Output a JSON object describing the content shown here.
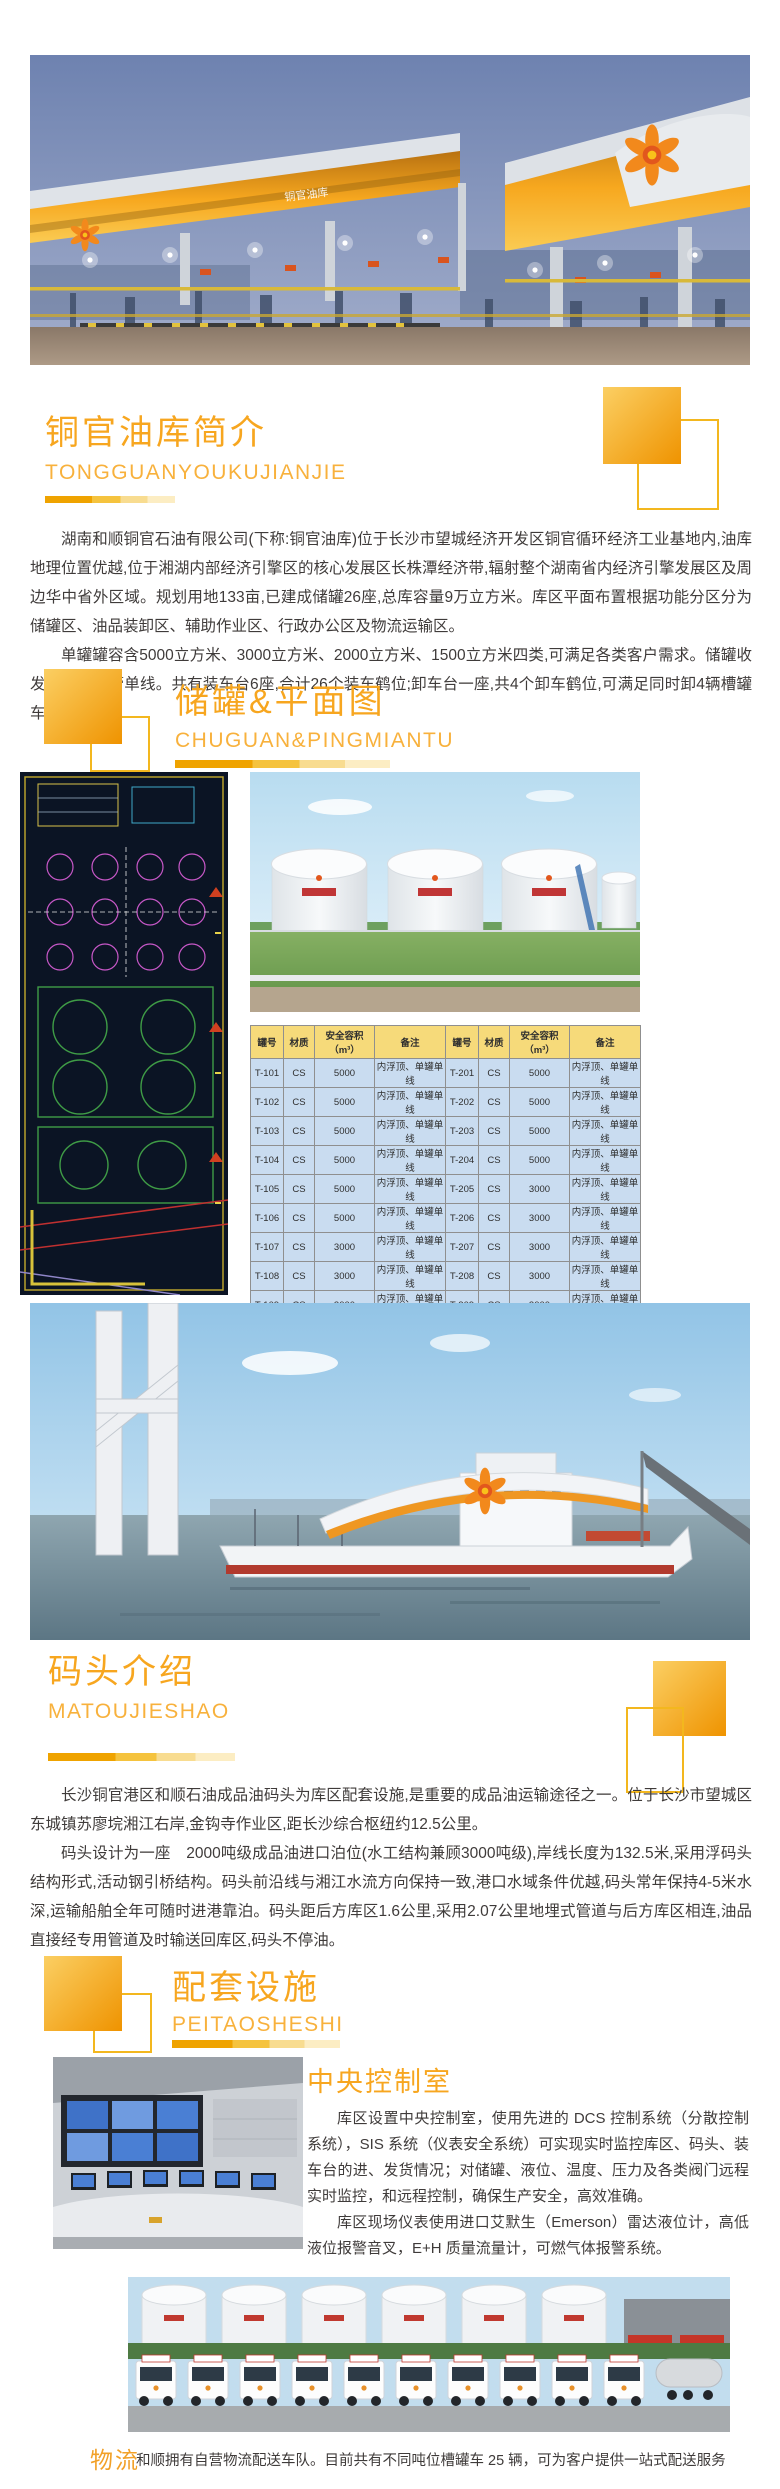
{
  "colors": {
    "accent_orange": "#F7A61F",
    "pinyin_orange": "#F8B13C",
    "table_header_bg": "#F6DA7A",
    "table_row_bg": "#C9DCF0",
    "body_text": "#3F3B3A"
  },
  "hero": {
    "canopy_sign": "铜官油库"
  },
  "section_intro": {
    "title": "铜官油库简介",
    "pinyin": "TONGGUANYOUKUJIANJIE",
    "paragraphs": {
      "p1": "湖南和顺铜官石油有限公司(下称:铜官油库)位于长沙市望城经济开发区铜官循环经济工业基地内,油库地理位置优越,位于湘湖内部经济引擎区的核心发展区长株潭经济带,辐射整个湖南省内经济引擎发展区及周边华中省外区域。规划用地133亩,已建成储罐26座,总库容量9万立方米。库区平面布置根据功能分区分为储罐区、油品装卸区、辅助作业区、行政办公区及物流运输区。",
      "p2": "单罐罐容含5000立方米、3000立方米、2000立方米、1500立方米四类,可满足各类客户需求。储罐收发油均为单管单线。共有装车台6座,合计26个装车鹤位;卸车台一座,共4个卸车鹤位,可满足同时卸4辆槽罐车。"
    }
  },
  "section_tanks": {
    "title": "储罐&平面图",
    "pinyin": "CHUGUAN&PINGMIANTU"
  },
  "tank_table": {
    "headers": [
      "罐号",
      "材质",
      "安全容积（m³）",
      "备注",
      "罐号",
      "材质",
      "安全容积（m³）",
      "备注"
    ],
    "rows": [
      [
        "T-101",
        "CS",
        "5000",
        "内浮顶、单罐单线",
        "T-201",
        "CS",
        "5000",
        "内浮顶、单罐单线"
      ],
      [
        "T-102",
        "CS",
        "5000",
        "内浮顶、单罐单线",
        "T-202",
        "CS",
        "5000",
        "内浮顶、单罐单线"
      ],
      [
        "T-103",
        "CS",
        "5000",
        "内浮顶、单罐单线",
        "T-203",
        "CS",
        "5000",
        "内浮顶、单罐单线"
      ],
      [
        "T-104",
        "CS",
        "5000",
        "内浮顶、单罐单线",
        "T-204",
        "CS",
        "5000",
        "内浮顶、单罐单线"
      ],
      [
        "T-105",
        "CS",
        "5000",
        "内浮顶、单罐单线",
        "T-205",
        "CS",
        "3000",
        "内浮顶、单罐单线"
      ],
      [
        "T-106",
        "CS",
        "5000",
        "内浮顶、单罐单线",
        "T-206",
        "CS",
        "3000",
        "内浮顶、单罐单线"
      ],
      [
        "T-107",
        "CS",
        "3000",
        "内浮顶、单罐单线",
        "T-207",
        "CS",
        "3000",
        "内浮顶、单罐单线"
      ],
      [
        "T-108",
        "CS",
        "3000",
        "内浮顶、单罐单线",
        "T-208",
        "CS",
        "3000",
        "内浮顶、单罐单线"
      ],
      [
        "T-109",
        "CS",
        "3000",
        "内浮顶、单罐单线",
        "T-209",
        "CS",
        "3000",
        "内浮顶、单罐单线"
      ],
      [
        "T-110",
        "CS",
        "3000",
        "内浮顶、单罐单线",
        "T-210",
        "CS",
        "3000",
        "内浮顶、单罐单线"
      ],
      [
        "T-111",
        "CS",
        "1500",
        "内浮顶、单罐单线",
        "T-211",
        "CS",
        "2000",
        "内浮顶、单罐单线"
      ],
      [
        "T-112",
        "CS",
        "1500",
        "内浮顶、单罐单线",
        "T-212",
        "CS",
        "2000",
        "内浮顶、单罐单线"
      ],
      [
        "T-214",
        "CS",
        "1500",
        "内浮顶、单罐单线",
        "T-213",
        "CS",
        "1500",
        "内浮顶、单罐单线"
      ]
    ]
  },
  "section_dock": {
    "title": "码头介绍",
    "pinyin": "MATOUJIESHAO",
    "paragraphs": {
      "p1": "长沙铜官港区和顺石油成品油码头为库区配套设施,是重要的成品油运输途径之一。位于长沙市望城区东城镇苏廖垸湘江右岸,金钩寺作业区,距长沙综合枢纽约12.5公里。",
      "p2": "码头设计为一座　2000吨级成品油进口泊位(水工结构兼顾3000吨级),岸线长度为132.5米,采用浮码头结构形式,活动钢引桥结构。码头前沿线与湘江水流方向保持一致,港口水域条件优越,码头常年保持4-5米水深,运输船舶全年可随时进港靠泊。码头距后方库区1.6公里,采用2.07公里地埋式管道与后方库区相连,油品直接经专用管道及时输送回库区,码头不停油。"
    }
  },
  "section_facilities": {
    "title": "配套设施",
    "pinyin": "PEITAOSHESHI"
  },
  "control_room": {
    "title": "中央控制室",
    "paragraphs": {
      "p1": "库区设置中央控制室，使用先进的 DCS 控制系统（分散控制系统），SIS 系统（仪表安全系统）可实现实时监控库区、码头、装车台的进、发货情况；对储罐、液位、温度、压力及各类阀门远程实时监控，和远程控制，确保生产安全，高效准确。",
      "p2": "库区现场仪表使用进口艾默生（Emerson）雷达液位计，高低液位报警音叉，E+H 质量流量计，可燃气体报警系统。"
    }
  },
  "logistics": {
    "label": "物流",
    "text": "和顺拥有自营物流配送车队。目前共有不同吨位槽罐车 25 辆，可为客户提供一站式配送服务"
  }
}
